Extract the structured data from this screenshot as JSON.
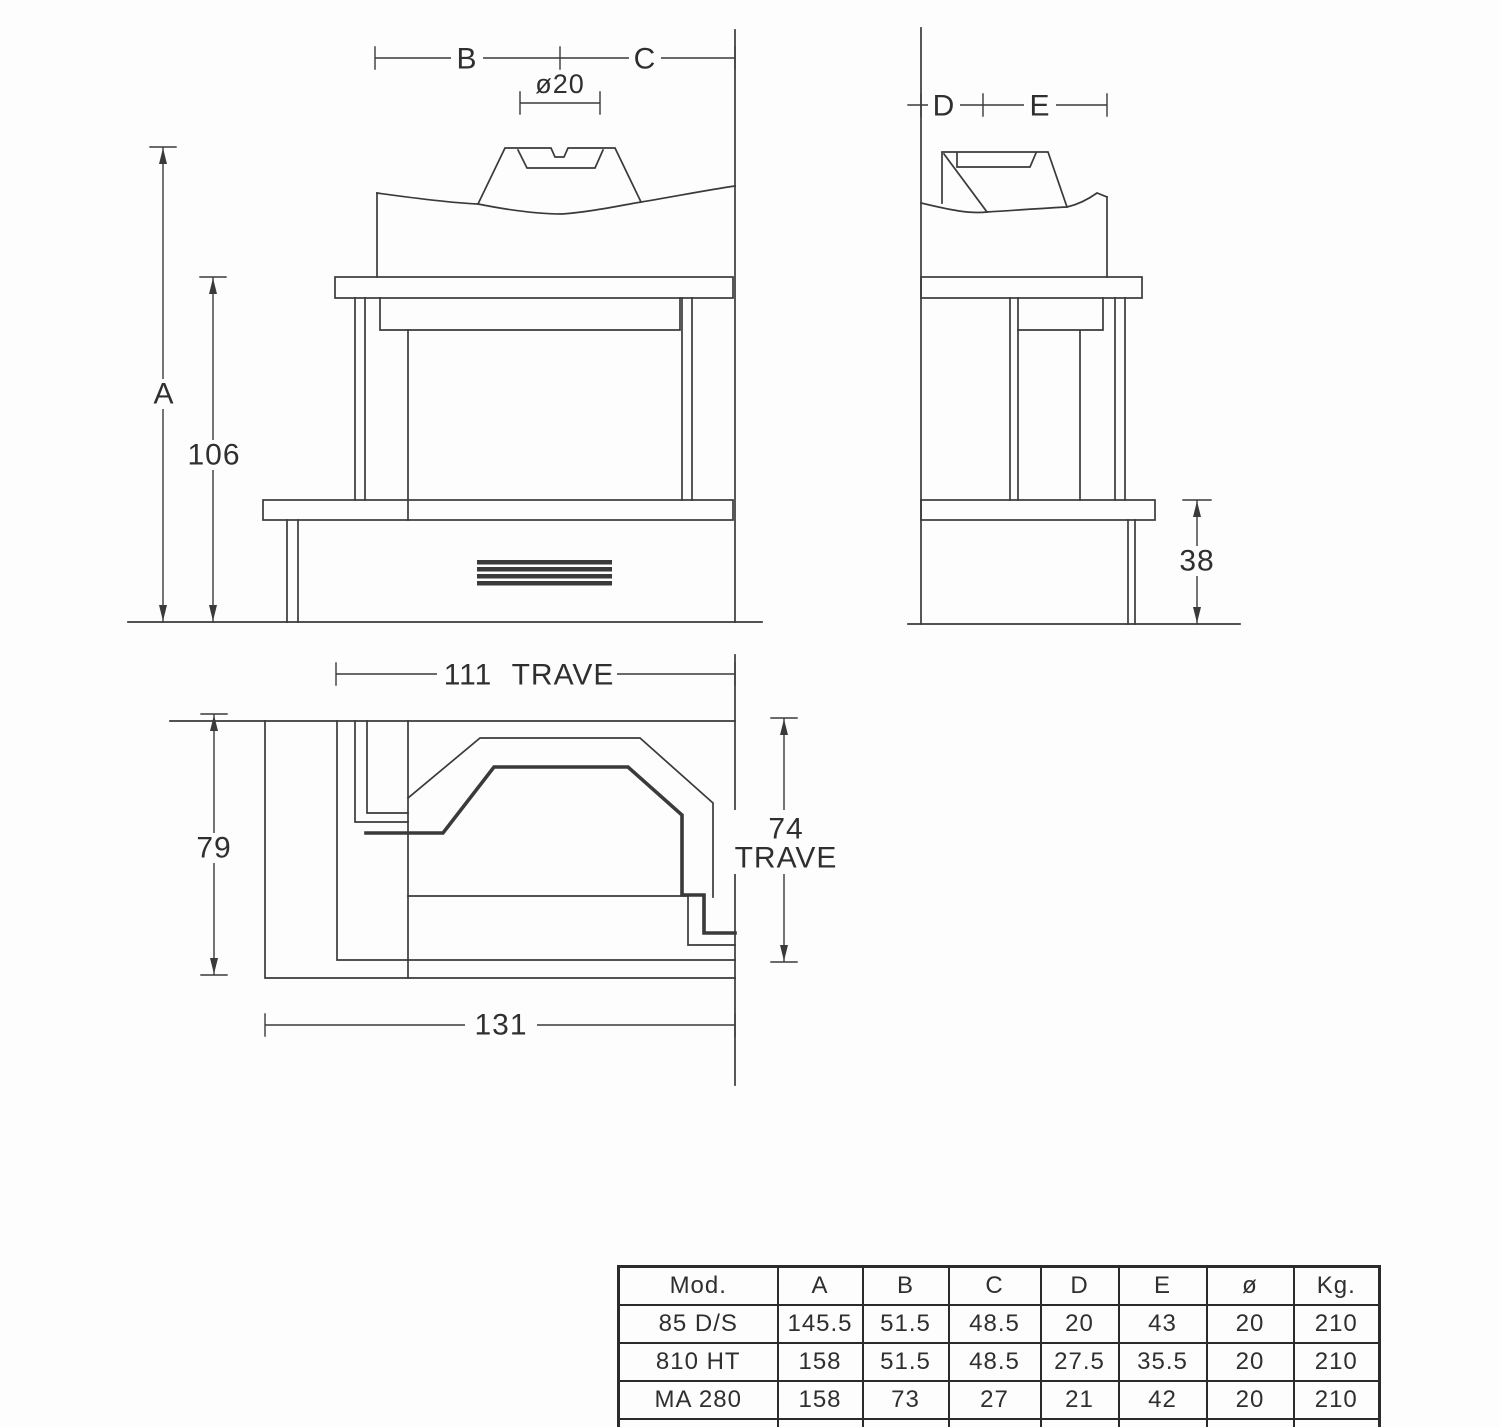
{
  "page": {
    "background": "#fdfdfd",
    "line_color": "#3a3a3a",
    "text_color": "#2f2f2f",
    "table_border_color": "#2b2b2b"
  },
  "front_view": {
    "dim_a": "A",
    "dim_height": "106",
    "dim_b": "B",
    "dim_c": "C",
    "dim_flue_diameter": "ø20"
  },
  "side_view": {
    "dim_d": "D",
    "dim_e": "E",
    "dim_hearth_height": "38"
  },
  "plan_view": {
    "dim_beam_width_num": "111",
    "dim_beam_width_word": "TRAVE",
    "dim_depth": "79",
    "dim_beam_depth_num": "74",
    "dim_beam_depth_word": "TRAVE",
    "dim_total_width": "131"
  },
  "spec_table": {
    "headers": [
      "Mod.",
      "A",
      "B",
      "C",
      "D",
      "E",
      "ø",
      "Kg."
    ],
    "rows": [
      [
        "85 D/S",
        "145.5",
        "51.5",
        "48.5",
        "20",
        "43",
        "20",
        "210"
      ],
      [
        "810 HT",
        "158",
        "51.5",
        "48.5",
        "27.5",
        "35.5",
        "20",
        "210"
      ],
      [
        "MA 280",
        "158",
        "73",
        "27",
        "21",
        "42",
        "20",
        "210"
      ],
      [
        "",
        "",
        "",
        "",
        "",
        "",
        "",
        ""
      ]
    ]
  }
}
